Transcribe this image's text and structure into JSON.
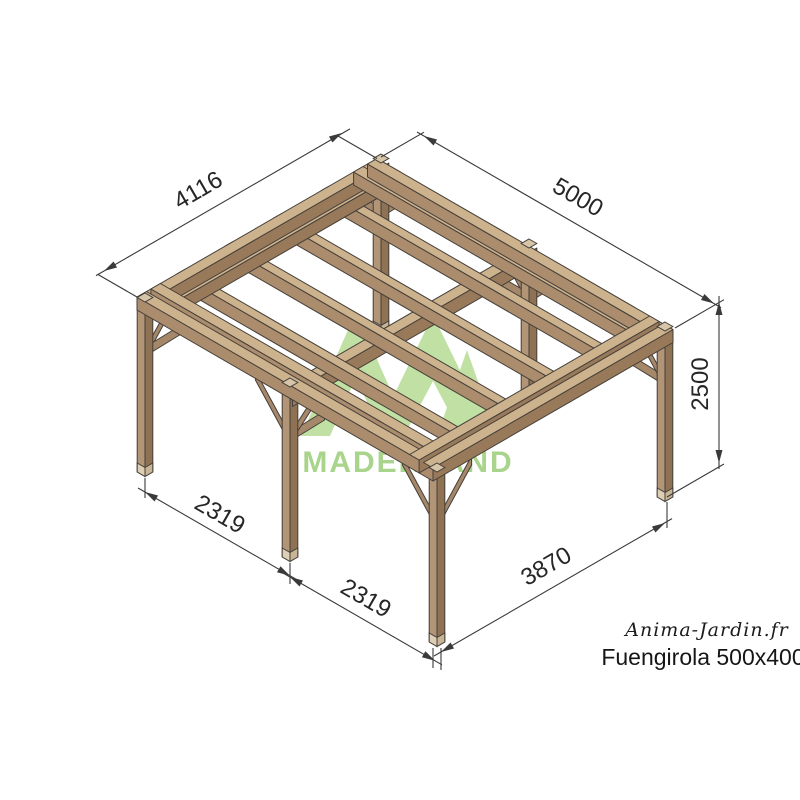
{
  "drawing": {
    "title": "Pergola isometric technical drawing",
    "watermark_text": "MADERLAND",
    "dimensions": {
      "depth_top_left": "4116",
      "width_top_right": "5000",
      "height_right": "2500",
      "post_spacing_left_1": "2319",
      "post_spacing_left_2": "2319",
      "post_spacing_front": "3870"
    },
    "branding": {
      "website": "Anima-Jardin.fr",
      "product_name": "Fuengirola 500x400"
    },
    "colors": {
      "wood_top": "#cdb28e",
      "wood_side_light": "#ab8d6e",
      "wood_side_dark": "#987a5b",
      "post_light": "#b29476",
      "post_dark": "#8f7254",
      "outline": "#443f39",
      "dimension_lines": "#3a3a3a",
      "logo_green": "#c0e0a4",
      "logo_text_green": "#a9d48b"
    }
  }
}
